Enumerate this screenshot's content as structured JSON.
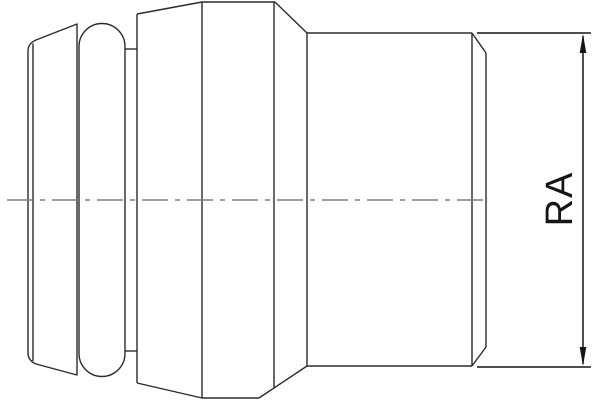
{
  "drawing": {
    "kind": "technical-line-drawing",
    "subject": "pipe-fitting-side-view",
    "dimension": {
      "label": "RA",
      "orientation": "vertical",
      "arrows": "both-ends"
    },
    "colors": {
      "background": "#ffffff",
      "outline": "#2b2b2b",
      "centerline": "#7d7d7d",
      "dimension": "#151515"
    }
  }
}
